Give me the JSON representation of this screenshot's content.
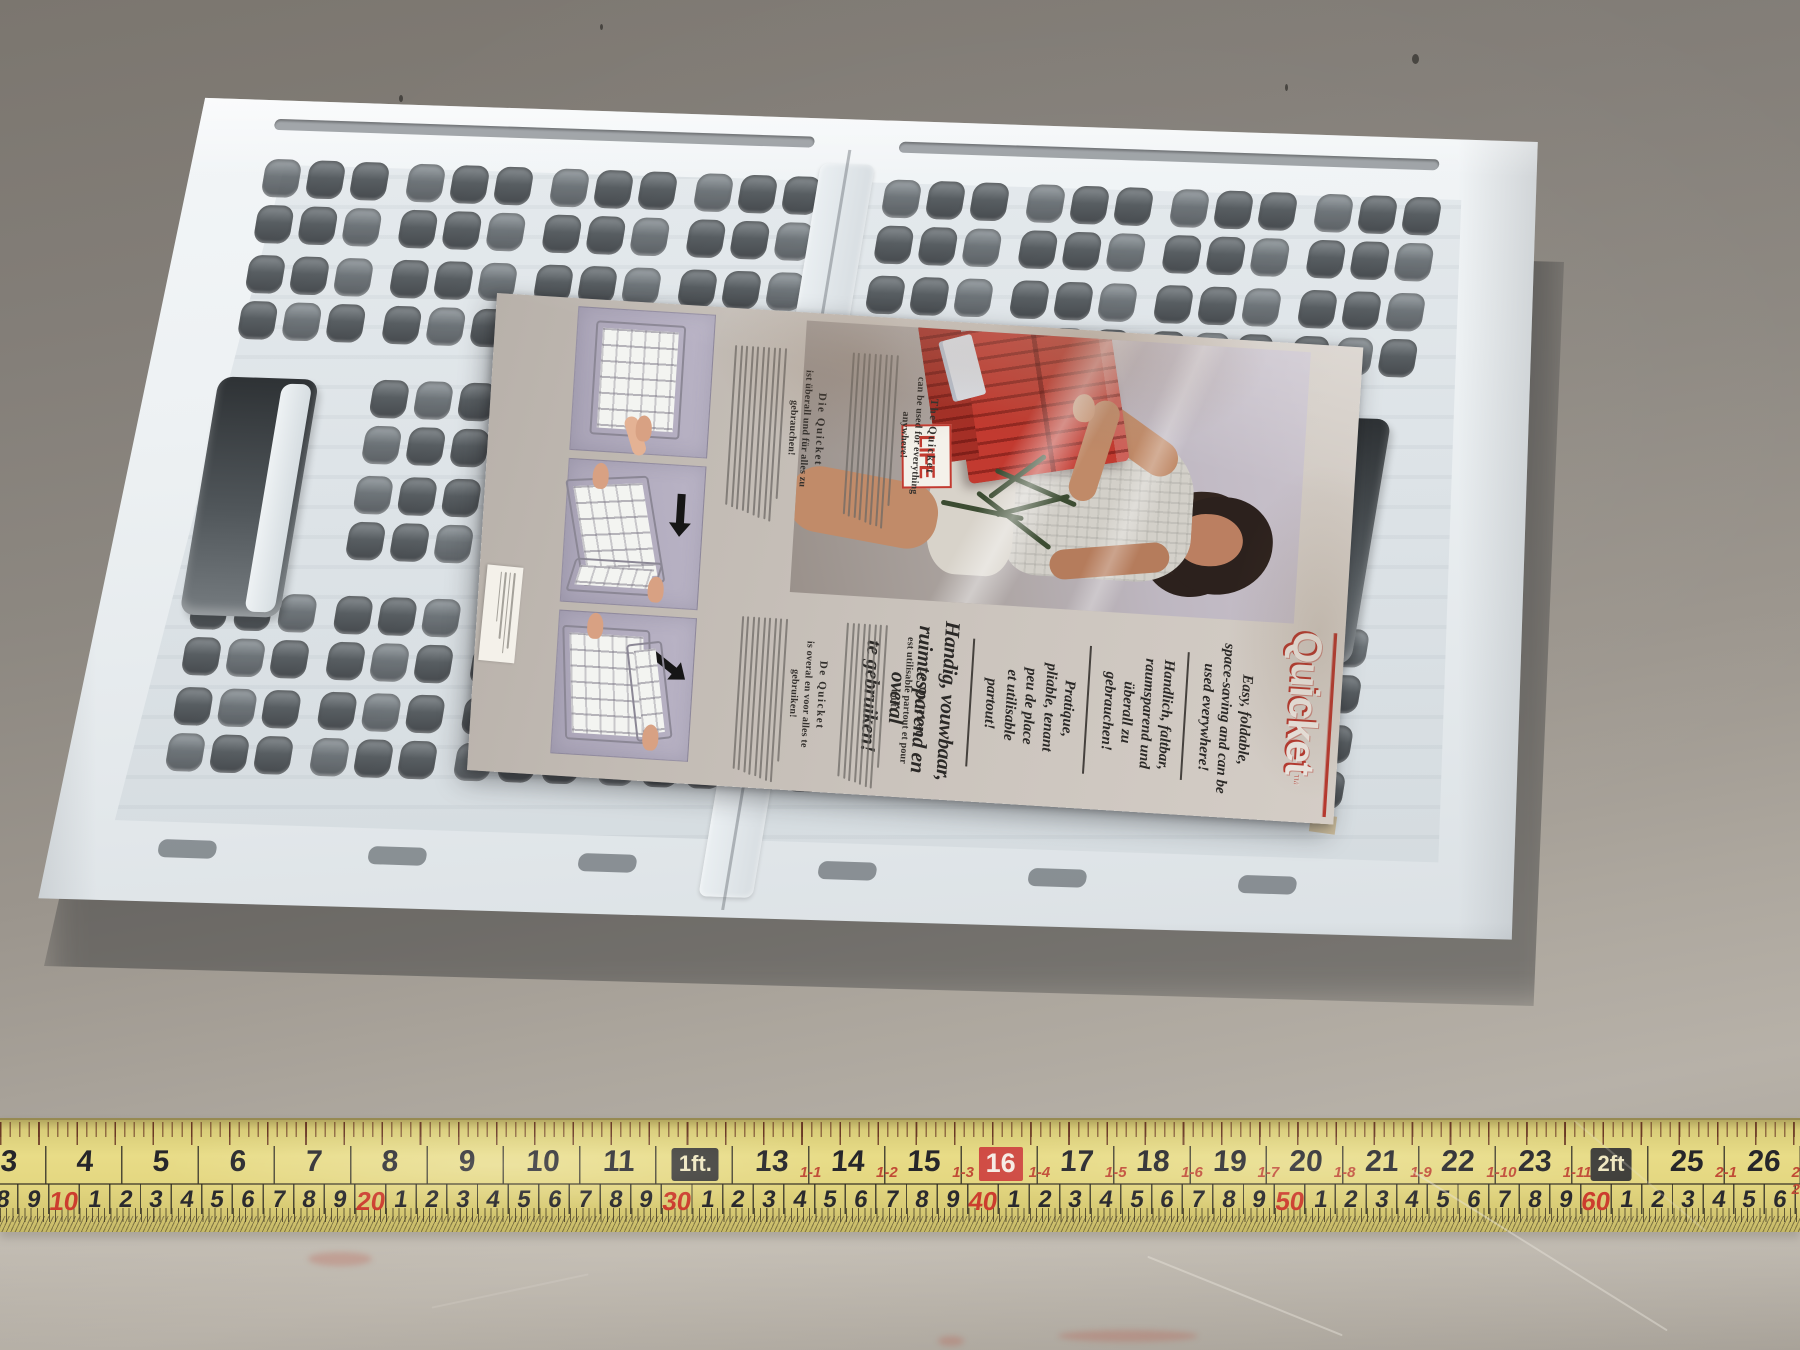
{
  "colors": {
    "accent_red": "#b5392f",
    "tape_yellow": "#e4d781",
    "leaflet_paper": "#ccc5be",
    "crate_white": "#edf1f3",
    "panel_lavender": "#b3adc0"
  },
  "leaflet": {
    "masthead": {
      "brand": "Quicket",
      "trademark": "™"
    },
    "headlines": [
      {
        "lang": "en",
        "size": "small",
        "lines": [
          "Easy, foldable,",
          "space-saving and can be",
          "used everywhere!"
        ]
      },
      {
        "lang": "de",
        "size": "small",
        "lines": [
          "Handlich, faltbar,",
          "raumsparend und",
          "überall zu",
          "gebrauchen!"
        ]
      },
      {
        "lang": "fr",
        "size": "small",
        "lines": [
          "Pratique,",
          "pliable, tenant",
          "peu de place",
          "et utilisable",
          "partout!"
        ]
      },
      {
        "lang": "nl",
        "size": "big",
        "lines": [
          "Handig, vouwbaar,",
          "ruimtesparend en",
          "overal",
          "te gebruiken!"
        ]
      }
    ],
    "columns": [
      {
        "lang": "en",
        "title_lines": [
          "The Quicket",
          "can be used for everything",
          "anywhere!"
        ],
        "body_lines": 9
      },
      {
        "lang": "de",
        "title_lines": [
          "Die Quicket",
          "ist überall und für alles zu",
          "gebrauchen!"
        ],
        "body_lines": 10
      },
      {
        "lang": "fr",
        "title_lines": [
          "Le Quicket",
          "est utilisable partout et pour",
          "tout!"
        ],
        "body_lines": 8
      },
      {
        "lang": "nl",
        "title_lines": [
          "De Quicket",
          "is overal en voor alles te",
          "gebruiken!"
        ],
        "body_lines": 9
      }
    ],
    "photo": {
      "poster_text": "LIFE"
    }
  },
  "tape": {
    "inches": [
      {
        "v": 3,
        "label": "3"
      },
      {
        "v": 4,
        "label": "4"
      },
      {
        "v": 5,
        "label": "5"
      },
      {
        "v": 6,
        "label": "6"
      },
      {
        "v": 7,
        "label": "7"
      },
      {
        "v": 8,
        "label": "8"
      },
      {
        "v": 9,
        "label": "9"
      },
      {
        "v": 10,
        "label": "10"
      },
      {
        "v": 11,
        "label": "11"
      },
      {
        "v": 12,
        "label": "1ft.",
        "style": "ft"
      },
      {
        "v": 13,
        "label": "13",
        "sub": "1-1"
      },
      {
        "v": 14,
        "label": "14",
        "sub": "1-2"
      },
      {
        "v": 15,
        "label": "15",
        "sub": "1-3"
      },
      {
        "v": 16,
        "label": "16",
        "style": "redbox",
        "sub": "1-4"
      },
      {
        "v": 17,
        "label": "17",
        "sub": "1-5"
      },
      {
        "v": 18,
        "label": "18",
        "sub": "1-6"
      },
      {
        "v": 19,
        "label": "19",
        "sub": "1-7"
      },
      {
        "v": 20,
        "label": "20",
        "sub": "1-8"
      },
      {
        "v": 21,
        "label": "21",
        "sub": "1-9"
      },
      {
        "v": 22,
        "label": "22",
        "sub": "1-10"
      },
      {
        "v": 23,
        "label": "23",
        "sub": "1-11"
      },
      {
        "v": 24,
        "label": "2ft",
        "style": "ft"
      },
      {
        "v": 25,
        "label": "25",
        "sub": "2-1"
      },
      {
        "v": 26,
        "label": "26",
        "sub": "2-2"
      }
    ],
    "cm": [
      "8",
      "9",
      "10",
      "1",
      "2",
      "3",
      "4",
      "5",
      "6",
      "7",
      "8",
      "9",
      "20",
      "1",
      "2",
      "3",
      "4",
      "5",
      "6",
      "7",
      "8",
      "9",
      "30",
      "1",
      "2",
      "3",
      "4",
      "5",
      "6",
      "7",
      "8",
      "9",
      "40",
      "1",
      "2",
      "3",
      "4",
      "5",
      "6",
      "7",
      "8",
      "9",
      "50",
      "1",
      "2",
      "3",
      "4",
      "5",
      "6",
      "7",
      "8",
      "9",
      "60",
      "1",
      "2",
      "3",
      "4",
      "5",
      "6",
      "7"
    ]
  }
}
